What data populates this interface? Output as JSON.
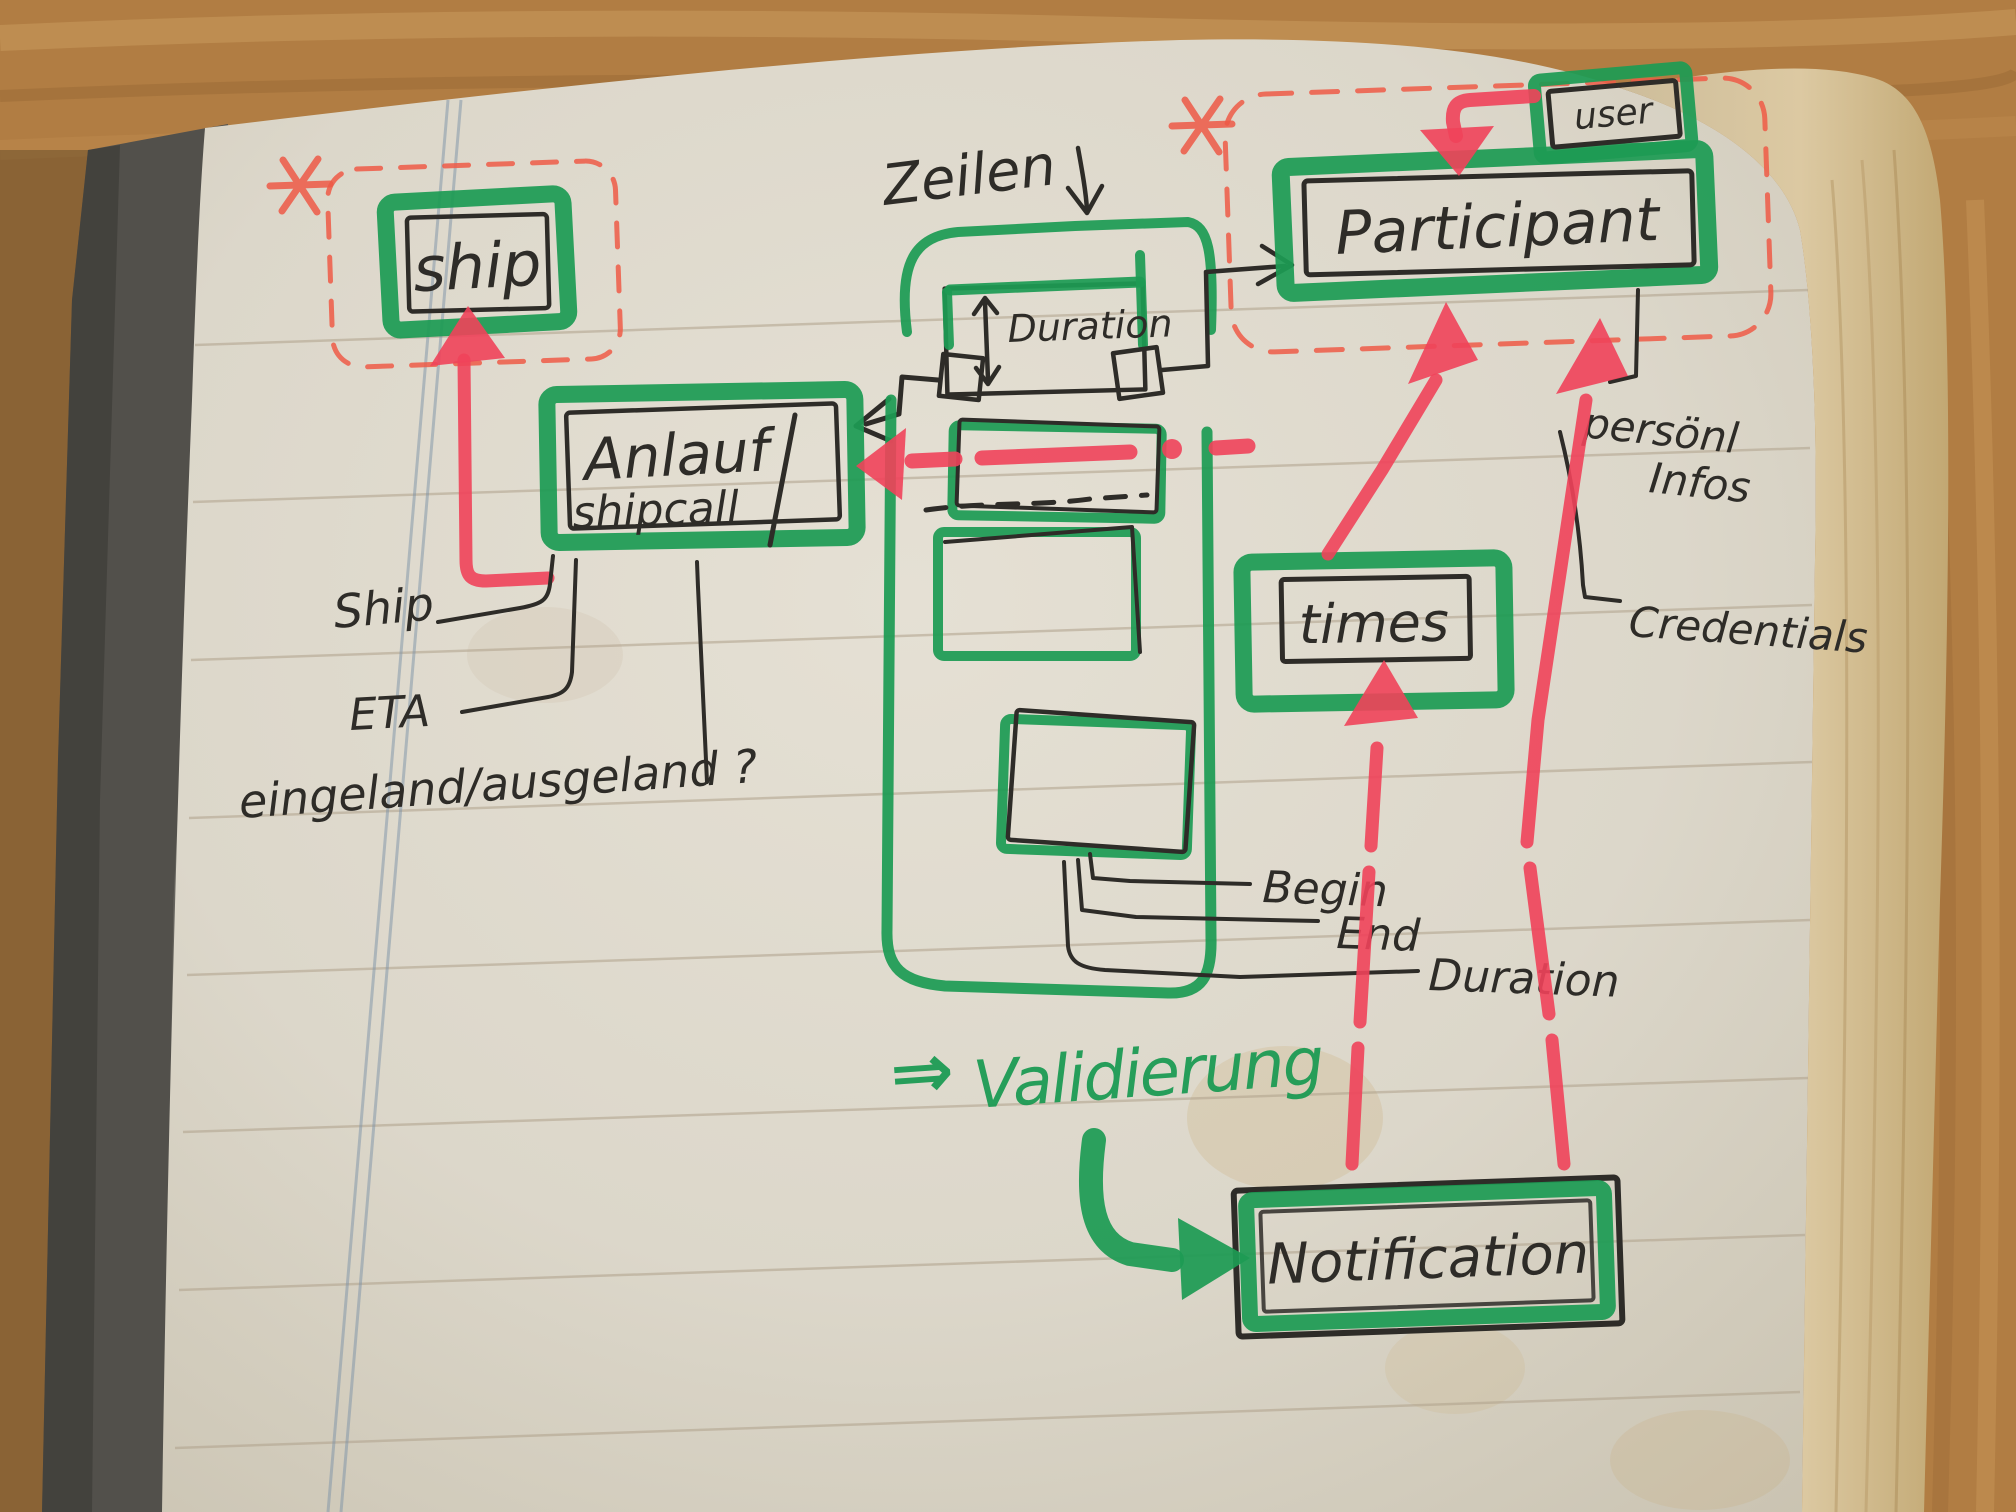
{
  "colors": {
    "marker_green": "#1d9b54",
    "marker_red": "#f0435a",
    "dashed_red": "#ee5a47",
    "pen_black": "#2e2c28",
    "page": "#ddd8cb",
    "page_edge": "#d6c49c",
    "wood": "#b17d43",
    "cover": "#52504b",
    "ruled_line": "#b0a28c",
    "margin_line": "#7d93a8"
  },
  "diagram": {
    "boxes": {
      "ship": "ship",
      "shipcall": {
        "line1": "Anlauf",
        "line2": "shipcall"
      },
      "participant": "Participant",
      "user": "user",
      "times": "times",
      "notification": "Notification",
      "duration": "Duration"
    },
    "annotations": {
      "zeilen": "Zeilen",
      "ship_attribute": "Ship",
      "eta": "ETA",
      "in_out": "eingeland/ausgeland ?",
      "begin": "Begin",
      "end": "End",
      "duration": "Duration",
      "personal_line1": "persönl",
      "personal_line2": "Infos",
      "credentials": "Credentials",
      "validierung_arrow": "⇒",
      "validierung": "Validierung"
    }
  }
}
